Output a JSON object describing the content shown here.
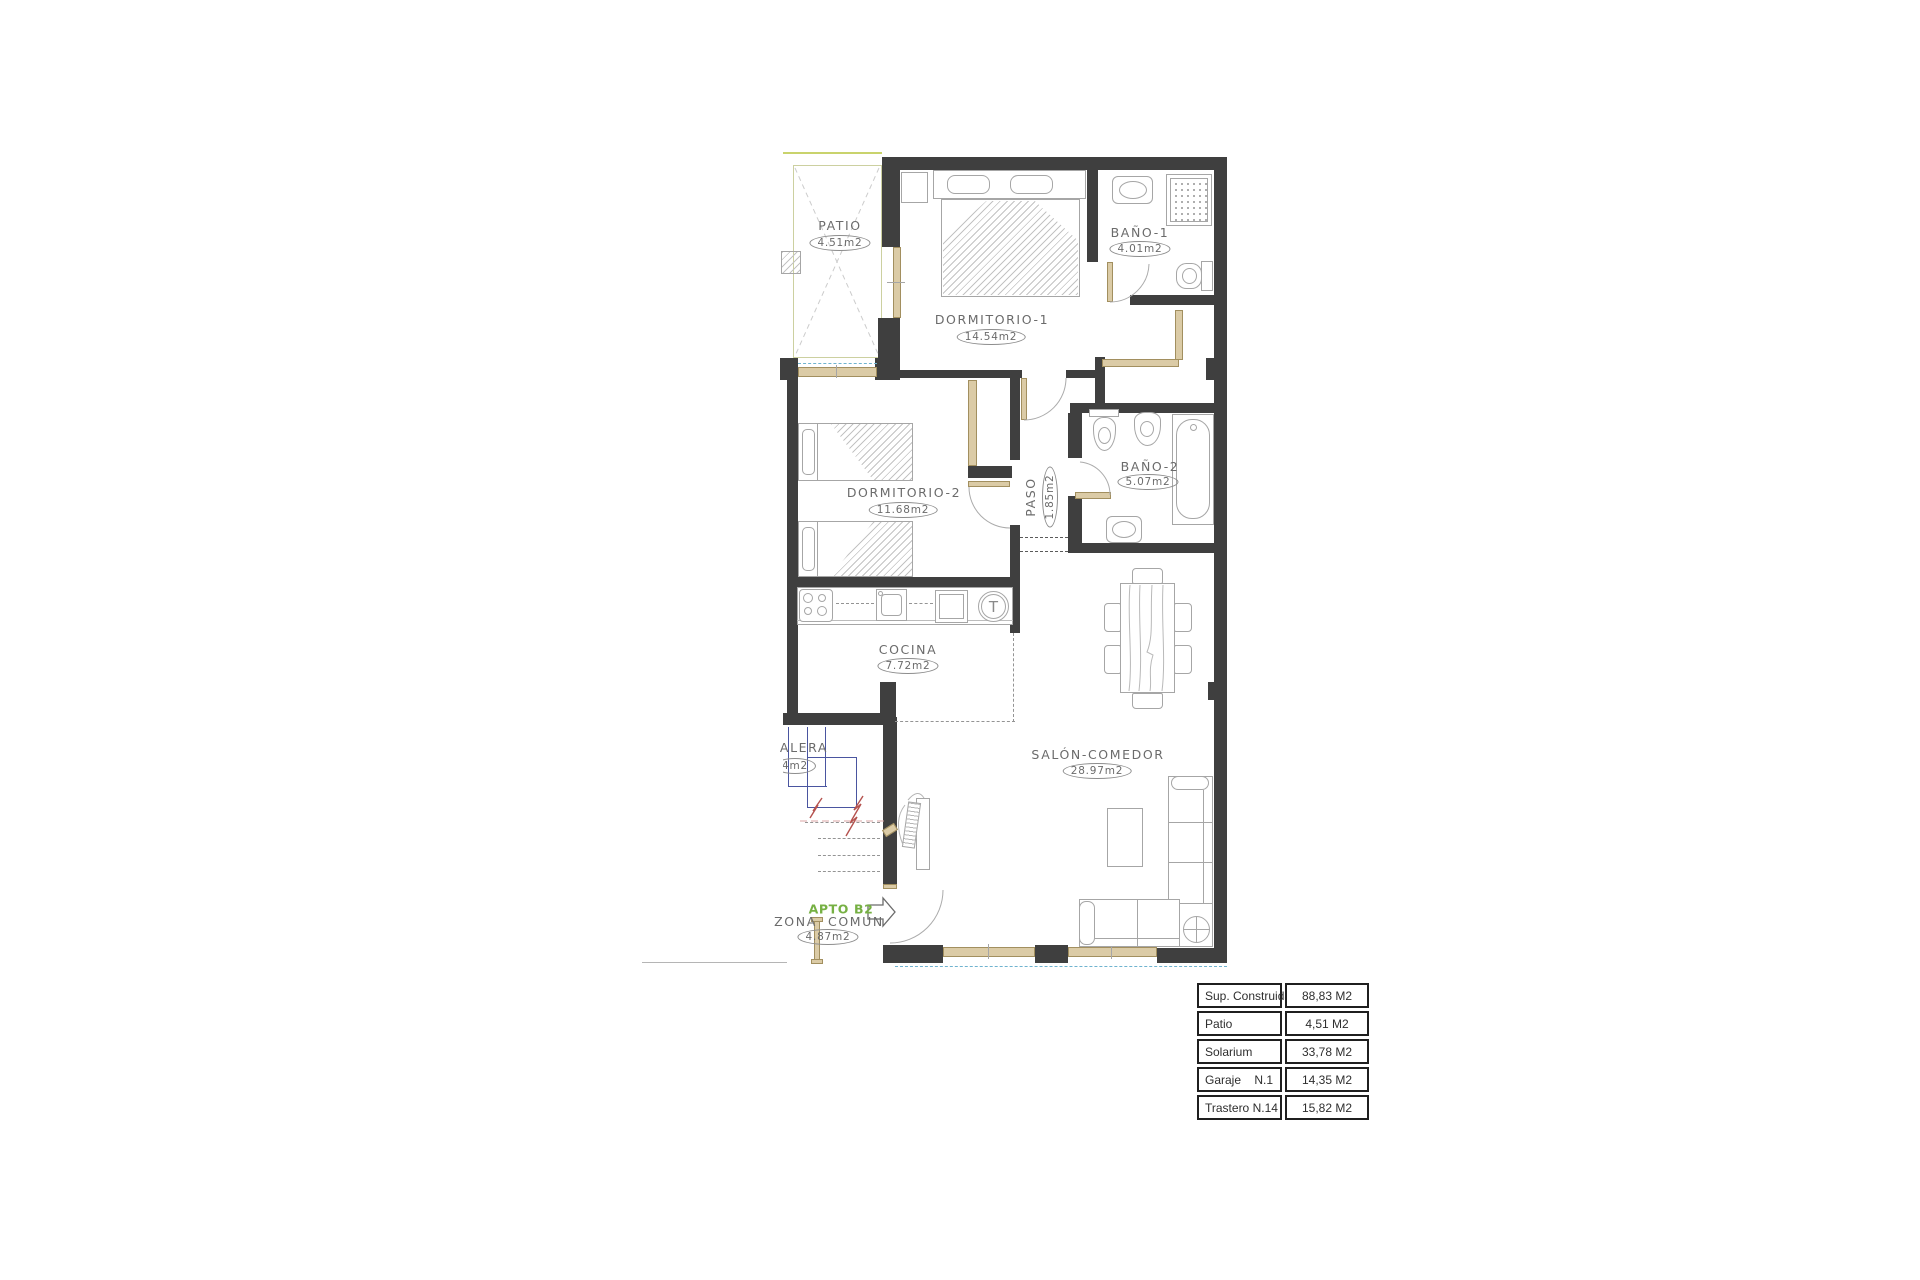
{
  "plan": {
    "apartment_label": "APTO B2",
    "rooms": [
      {
        "id": "patio",
        "name": "PATIO",
        "area": "4.51m2"
      },
      {
        "id": "dormitorio1",
        "name": "DORMITORIO-1",
        "area": "14.54m2"
      },
      {
        "id": "bano1",
        "name": "BAÑO-1",
        "area": "4.01m2"
      },
      {
        "id": "dormitorio2",
        "name": "DORMITORIO-2",
        "area": "11.68m2"
      },
      {
        "id": "paso",
        "name": "PASO",
        "area": "1.85m2"
      },
      {
        "id": "bano2",
        "name": "BAÑO-2",
        "area": "5.07m2"
      },
      {
        "id": "cocina",
        "name": "COCINA",
        "area": "7.72m2"
      },
      {
        "id": "salon",
        "name": "SALÓN-COMEDOR",
        "area": "28.97m2"
      },
      {
        "id": "escalera",
        "name": "ALERA",
        "area": "4m2"
      },
      {
        "id": "zona_comun",
        "name": "ZONA  COMUN",
        "area": "4.87m2"
      }
    ],
    "fixtures": {
      "water_heater_label": "T"
    },
    "colors": {
      "wall": "#3f3f3f",
      "wood_trim": "#dbcba6",
      "apto_green": "#76b043",
      "patio_line": "#c9d36c",
      "stair_blue": "#4a55a0",
      "break_red": "#b5524e",
      "dashed_blue": "#6fb3cf"
    }
  },
  "summary_table": {
    "rows": [
      {
        "label": "Sup. Construida",
        "value": "88,83 M2"
      },
      {
        "label": "Patio",
        "value": "4,51 M2"
      },
      {
        "label": "Solarium",
        "value": "33,78 M2"
      },
      {
        "label": "Garaje    N.1",
        "value": "14,35 M2"
      },
      {
        "label": "Trastero N.14",
        "value": "15,82 M2"
      }
    ]
  }
}
